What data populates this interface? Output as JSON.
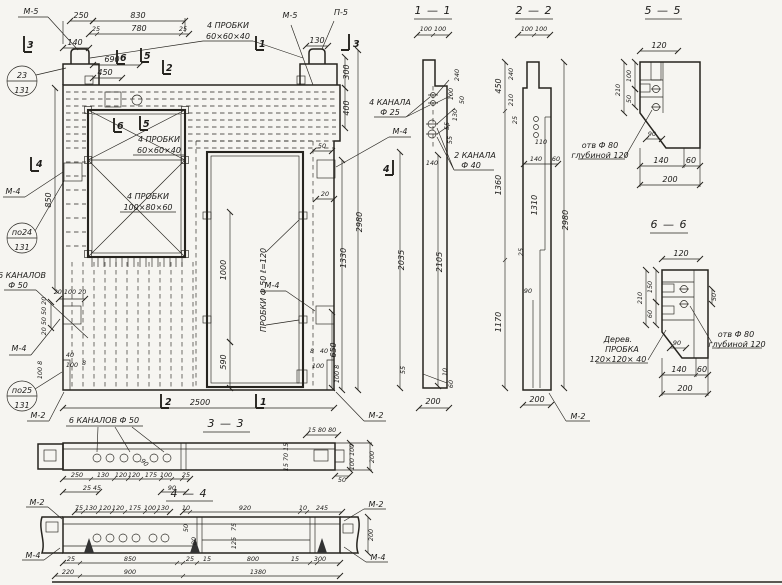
{
  "colors": {
    "ink": "#26241f",
    "paper": "#f6f5f1"
  },
  "v": {
    "main": {
      "m5l": "М-5",
      "m5r": "М-5",
      "p5": "П-5",
      "probki_top": "4 ПРОБКИ",
      "probki_top_s": "60×60×40",
      "probki_w1": "4 ПРОБКИ",
      "probki_w1_s": "60×60×40",
      "probki_w2": "4 ПРОБКИ",
      "probki_w2_s": "100×80×60",
      "probki_door": "ПРОБКИ Ф 50 ℓ=120",
      "kan50": "6 КАНАЛОВ",
      "kan50_s": "Ф 50",
      "m4_tl": "М-4",
      "m4_tr": "М-4",
      "m4_mr": "М-4",
      "m4_bl": "М-4",
      "m2_bl": "М-2",
      "m2_br": "М-2",
      "b1a": "23",
      "b1b": "131",
      "b2a": "по24",
      "b2b": "131",
      "b3a": "по25",
      "b3b": "131",
      "mk3l": "3",
      "mk3r": "3",
      "mk1": "1",
      "mk2": "2",
      "mk5": "5",
      "mk6": "6",
      "mk5w": "5",
      "mk6w": "6",
      "mk4l": "4",
      "mk4r": "4",
      "mk1b": "1",
      "mk2b": "2",
      "d250": "250",
      "d830": "830",
      "d140": "140",
      "d25a": "25",
      "d780": "780",
      "d25b": "25",
      "d690": "690",
      "d450": "450",
      "d130": "130",
      "d300": "300",
      "d400": "400",
      "d50r": "50",
      "d20r": "20",
      "d1330": "1330",
      "d2980": "2980",
      "d650": "650",
      "d850": "850",
      "d1000": "1000",
      "d590": "590",
      "d2500": "2500",
      "ins_h": "20 100 20",
      "ins_v": "20 50 50 20",
      "bl40": "40",
      "bl100": "100",
      "bl8": "8",
      "blv": "100 8",
      "br8": "8",
      "br40": "40",
      "br100": "100",
      "brv": "100 8"
    },
    "s11": {
      "title": "1 — 1",
      "t100": "100  100",
      "kan25": "4 КАНАЛА",
      "kan25_s": "Ф 25",
      "kan40": "2 КАНАЛА",
      "kan40_s": "Ф 40",
      "r240": "240",
      "r100": "100",
      "r50": "50",
      "r130": "130",
      "r55a": "55",
      "r55b": "55",
      "i140": "140",
      "v2105": "2105",
      "v2035": "2035",
      "b55": "55",
      "b10": "10",
      "b60": "60",
      "b200": "200"
    },
    "s22": {
      "title": "2 — 2",
      "t100": "100  100",
      "l450": "450",
      "l1360": "1360",
      "l1170": "1170",
      "i240": "240",
      "i210": "210",
      "i25a": "25",
      "i110": "110",
      "i140": "140",
      "i60": "60",
      "i1310": "1310",
      "i25b": "25",
      "i90": "90",
      "r2980": "2980",
      "b200": "200",
      "m2": "М-2"
    },
    "s33": {
      "title": "3 — 3",
      "kan": "6 КАНАЛОВ Ф 50",
      "d250": "250",
      "d130": "130",
      "d120a": "120",
      "d120b": "120",
      "d175": "175",
      "d100": "100",
      "d25a": "25",
      "d25b": "25",
      "d45": "45",
      "d90": "90",
      "d90r": "90",
      "t158080": "15 80 80",
      "rv": "15 70 15",
      "rv100": "100 100",
      "rv200": "200",
      "d50": "50"
    },
    "s44": {
      "title": "4 — 4",
      "t75": "75",
      "t130a": "130",
      "t120a": "120",
      "t120b": "120",
      "t175": "175",
      "t100": "100",
      "t130b": "130",
      "t10a": "10",
      "t920": "920",
      "t10b": "10",
      "t245": "245",
      "i50": "50",
      "i80": "80",
      "i75": "75",
      "i125": "125",
      "r200": "200",
      "b25a": "25",
      "b850": "850",
      "b25b": "25",
      "b15a": "15",
      "b800": "800",
      "b15b": "15",
      "b300": "300",
      "b220": "220",
      "b900": "900",
      "b1380": "1380",
      "m2l": "М-2",
      "m4l": "М-4",
      "m2r": "М-2",
      "m4r": "М-4"
    },
    "s55": {
      "title": "5 — 5",
      "t120": "120",
      "l210": "210",
      "l100": "100",
      "l50": "50",
      "i90": "90",
      "otv1": "отв Ф 80",
      "otv2": "глубиной 120",
      "b140": "140",
      "b60": "60",
      "b200": "200"
    },
    "s66": {
      "title": "6 — 6",
      "t120": "120",
      "l210": "210",
      "l150": "150",
      "l60": "60",
      "r50": "50",
      "i90": "90",
      "p1": "Дерев.",
      "p2": "ПРОБКА",
      "p3": "120×120× 40",
      "otv1": "отв Ф 80",
      "otv2": "глубиной 120",
      "b140": "140",
      "b60": "60",
      "b200": "200"
    }
  }
}
